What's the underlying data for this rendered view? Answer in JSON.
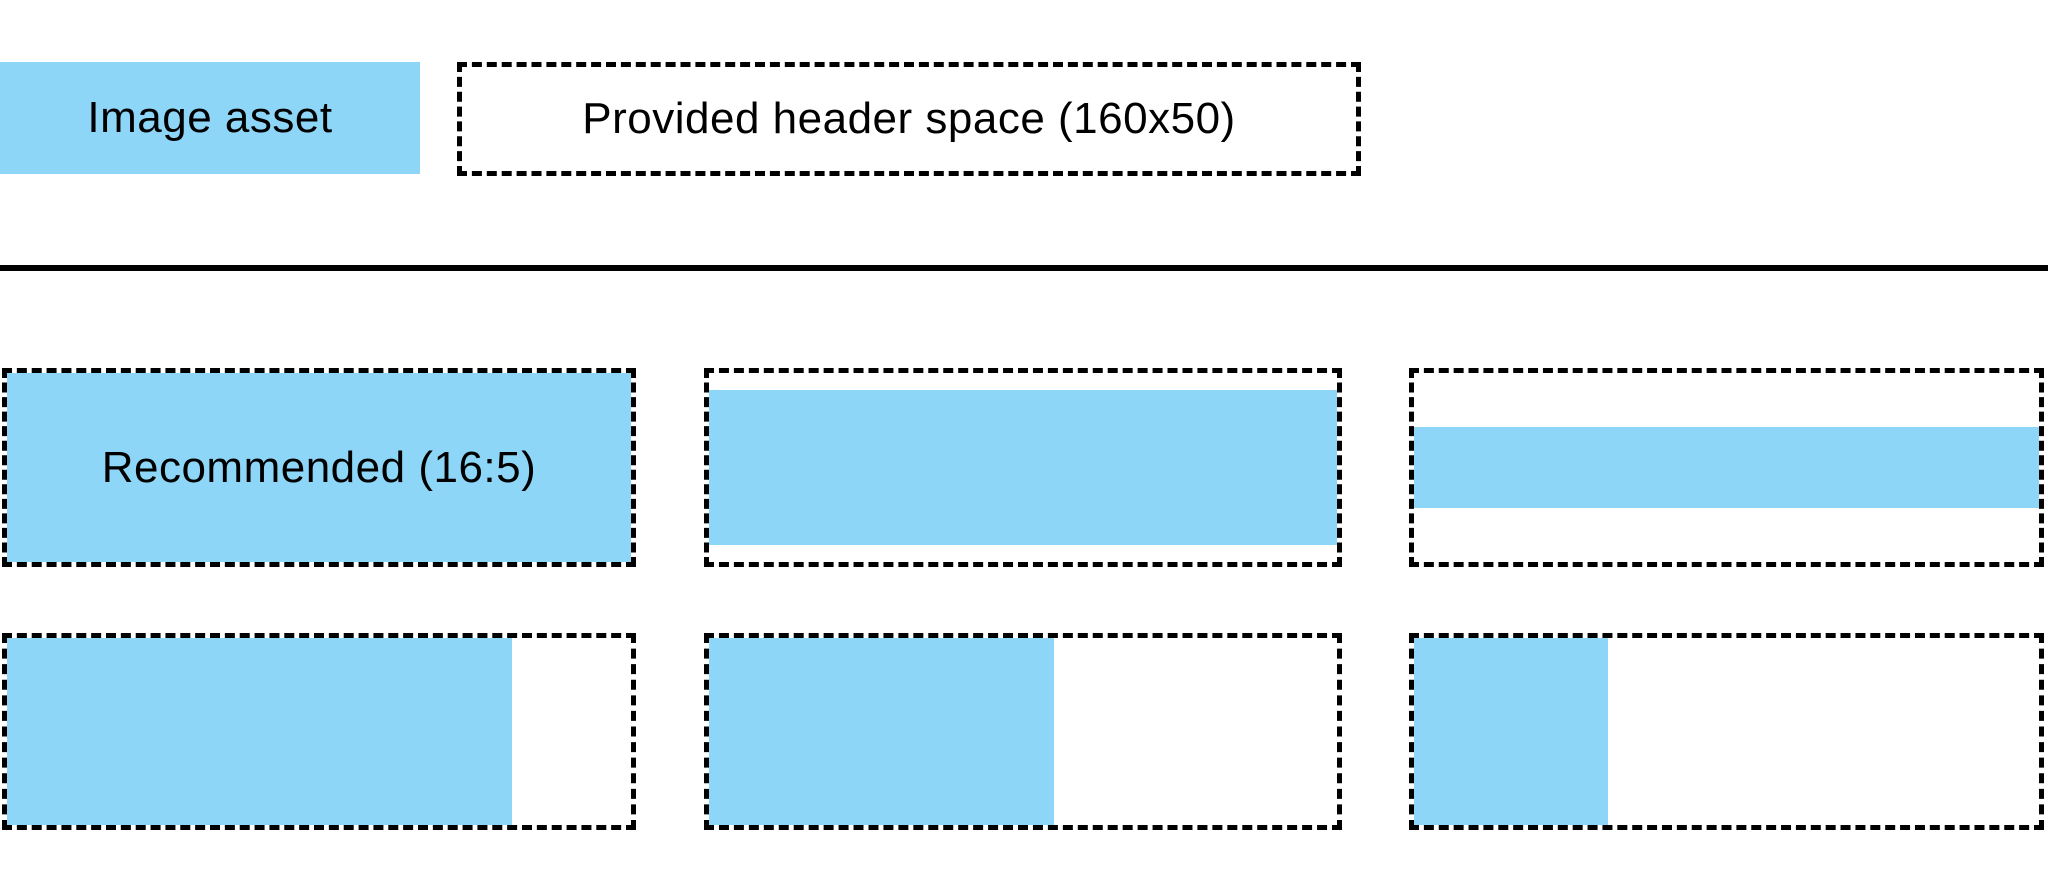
{
  "colors": {
    "asset_blue": "#8DD6F7",
    "line_black": "#000000"
  },
  "legend": {
    "asset_label": "Image asset",
    "header_space_label": "Provided header space (160x50)"
  },
  "examples": [
    {
      "id": "recommended-16-5",
      "label": "Recommended (16:5)",
      "asset": {
        "width": "100%",
        "height": "100%"
      }
    },
    {
      "id": "full-width-tall",
      "label": "",
      "asset": {
        "width": "100%",
        "height": "82%"
      }
    },
    {
      "id": "full-width-thin",
      "label": "",
      "asset": {
        "width": "100%",
        "height": "43%"
      }
    },
    {
      "id": "full-height-wide",
      "label": "",
      "asset": {
        "width": "81%",
        "height": "100%"
      }
    },
    {
      "id": "full-height-medium",
      "label": "",
      "asset": {
        "width": "55%",
        "height": "100%"
      }
    },
    {
      "id": "full-height-narrow",
      "label": "",
      "asset": {
        "width": "31%",
        "height": "100%"
      }
    }
  ]
}
